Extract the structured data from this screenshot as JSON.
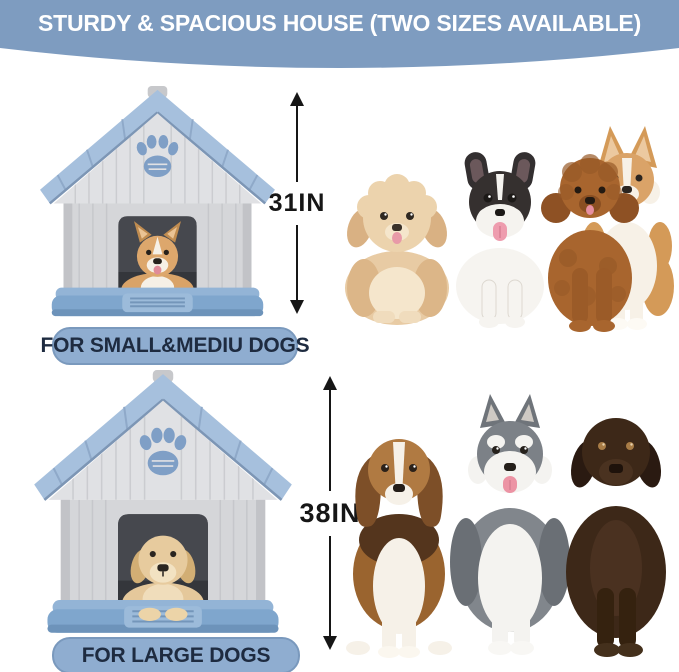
{
  "banner": {
    "title": "STURDY & SPACIOUS HOUSE (TWO SIZES AVAILABLE)"
  },
  "small_section": {
    "measurement": "31IN",
    "label": "FOR SMALL&MEDIU DOGS"
  },
  "large_section": {
    "measurement": "38IN",
    "label": "FOR LARGE DOGS"
  },
  "icons": {
    "paw_print": "paw-print-icon",
    "height_arrow": "double-headed-vertical-arrow-icon"
  },
  "colors": {
    "background": "#ffffff",
    "banner_bg": "#7e9cc0",
    "banner_text": "#ffffff",
    "pill_bg": "#8fadd0",
    "pill_border": "#7a99bd",
    "pill_text": "#1e2b40",
    "measure_text": "#161616",
    "house_roof_blue": "#a6c0dd",
    "house_wall_gray": "#d5d6d9",
    "house_base_blue": "#7fa6cd",
    "paw_blue": "#7f9fc6"
  }
}
